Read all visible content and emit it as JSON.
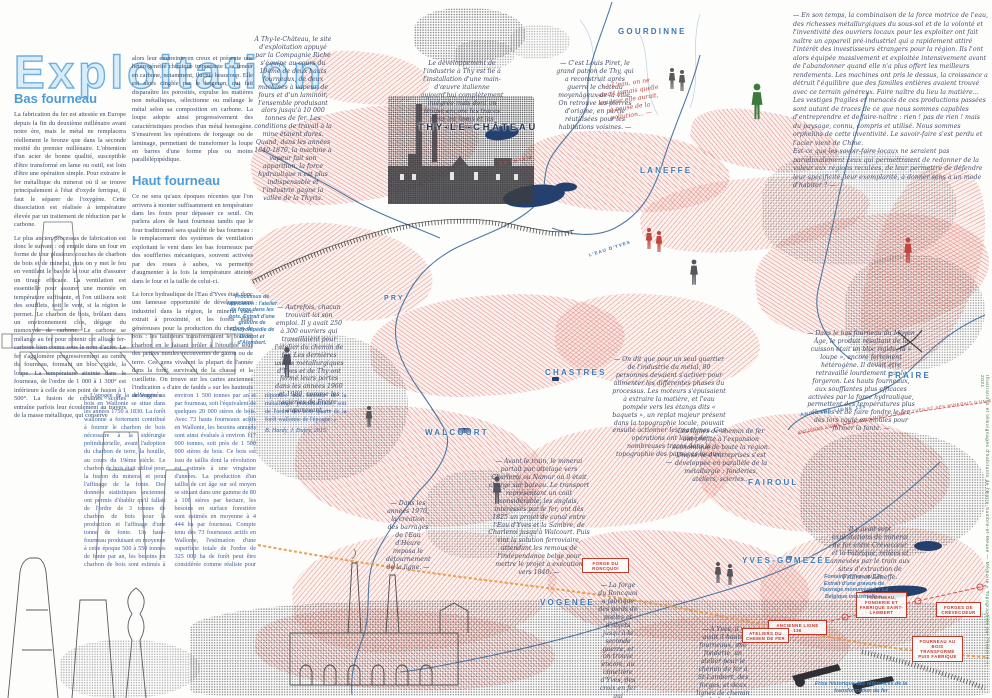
{
  "page": {
    "title": "Exploitation"
  },
  "article": {
    "bas": {
      "heading": "Bas fourneau",
      "p1": "La fabrication du fer est attestée en Europe depuis la fin du deuxième millénaire avant notre ère, mais le métal ne remplacera réellement le bronze que dans la seconde moitié du premier millénaire. L'obtention d'un acier de bonne qualité, susceptible d'être transformé en lame ou outil, est loin d'être une opération simple. Pour extraire le fer métallique du minerai où il se trouve principalement à l'état d'oxyde ferrique, il faut le séparer de l'oxygène. Cette dissociation est réalisée à température élevée par un traitement de réduction par le carbone.",
      "p2": "Le plus ancien processus de fabrication est donc le suivant : on empile dans un four en forme de tour plusieurs couches de charbon de bois et de minerai, puis on y met le feu en ventilant le bas de la tour afin d'assurer un tirage efficace. La ventilation est essentielle pour assurer une montée en température suffisante, et l'on utilisera soit des soufflets, soit le vent, si la région le permet. Le charbon de bois, brûlant dans un environnement clos, dégage du monoxyde de carbone. Le carbone se mélange au fer pour obtenir cet alliage fer-carbone bien connu sous le nom d'acier. Le fer s'agglomère progressivement au centre du fourneau, formant un bloc rigide, la loupe. La température atteinte dans le fourneau, de l'ordre de 1 000 à 1 300° est inférieure à celle de son point de fusion à 1 500°. La fusion de certaines scories entraîne parfois leur écoulement au travers de la masse métallique, qui conserve"
    },
    "cont": "alors leur empreinte en creux et présente une hétérogénéité chimique importante : sa teneur en carbone, notamment, fluctue beaucoup. Elle est alors cinglée par le forgeron, qui fait disparaître les porosités, expulse les matières non métalliques, sélectionne ou mélange le métal selon sa composition en carbone. La loupe adopte ainsi progressivement des caractéristiques proches d'un métal homogène. S'ensuivent les opérations de forgeage ou de laminage, permettant de transformer la loupe en barres d'une forme plus ou moins parallélépipédique.",
    "haut": {
      "heading": "Haut fourneau",
      "p1": "Ce ne sera qu'aux époques récentes que l'on arrivera à monter suffisamment en température dans les fours pour dépasser ce seuil. On parlera alors de haut fourneau tandis que le four traditionnel sera qualifié de bas fourneau : le remplacement des systèmes de ventilation exploitant le vent dans les bas fourneaux par des souffleries mécaniques, souvent activées par des roues à aubes, va permettre d'augmenter à la fois la température atteinte dans le four et la taille de celui-ci.",
      "p2": "La force hydraulique de l'Eau d'Yves était donc une fameuse opportunité de développement industriel dans la région, le minerai étant extrait à proximité, et les forêts étant généreuses pour la production du charbon de bois : les fauldeurs transformaient le bois en charbon en le faisant brûler à l'étouffée sous des petites meules recouvertes de gazon ou de terre. Ces gens vivaient la plupart de l'année dans la forêt, survivant de la chasse et la cueillette. On trouve sur les cartes anciennes l'indication « d'aire de faulds » sur les hauteurs de Vogenée."
    },
    "quote": {
      "text": "« L'apogée de la sidérurgie au bois en Wallonie se situe dans les années 1750 à 1830. La forêt wallonne a fortement contribué à fournir le charbon de bois nécessaire à la sidérurgie préindustrielle, avant l'adoption du charbon de terre, la houille, au cours du 19ème siècle. Le charbon de bois était utilisé pour la fusion du minerai et pour l'affinage de la fonte. Des données statistiques anciennes ont permis d'établir qu'il fallait de l'ordre de 3 tonnes de charbon de bois pour la production et l'affinage d'une tonne de fonte. Un haut-fourneau produisant en moyenne à cette époque 500 à 550 tonnes de fonte par an, les besoins en charbon de bois sont estimés à environ 1 500 tonnes par an et par fourneau, soit l'équivalent de quelques 20 000 stères de bois. Avec 73 hauts fourneaux actifs en Wallonie, les besoins annuels sont ainsi évalués à environ 117 000 tonnes, soit près de 1 500 000 stères de bois. Ce bois est issu de taillis dont la révolution est estimée à une vingtaine d'années. La production d'un taillis de cet âge sur sol moyen se situant dans une gamme de 80 à 100 stères par hectare, les besoins en surface forestière sont estimés en moyenne à 4 444 ha par fourneau. Compte tenu des 73 fourneaux actifs en Wallonie, l'estimation d'une superficie totale de l'ordre de 325 000 ha de forêt peut être considérée comme réaliste pour répondre aux besoins de la métallurgie préindustrielle, soit de l'ordre des trois quarts de la forêt wallonne de l'époque. »",
      "attribution": "B. Hardy, J. Dufey, 2015."
    }
  },
  "manifesto": {
    "text": "— En son temps, la combinaison de la force motrice de l'eau, des richesses métallurgiques du sous-sol et de la volonté et l'inventivité des ouvriers locaux pour les exploiter ont fait naître un appareil pré-industriel qui a rapidement attiré l'intérêt des investisseurs étrangers pour la région. Ils l'ont alors équipée massivement et exploitée intensivement avant de l'abandonner quand elle n'a plus offert les meilleurs rendements. Les machines ont pris le dessus, la croissance a détruit l'équilibre que des familles entières avaient trouvé avec ce terrain généreux. Faire naître du lieu la matière...\nLes vestiges fragiles et menacés de ces productions passées sont autant de traces de ce que nous sommes capables d'entreprendre et de faire-naître : rien ! pas de rien ! mais du paysage, connu, compris et utilisé. Nous sommes orphelins de cette inventivité. Le savoir-faire s'est perdu et l'acier vient de Chine.\nEst-ce que les savoir-faire locaux ne seraient pas paradoxalement ceux qui permettraient de redonner de la valeur aux régions reculées, de leur permettre de défendre leur spécificité, leur exemplarité, à donner sens à un mode d'habiter ? —"
  },
  "map": {
    "places": [
      {
        "name": "GOURDINNE"
      },
      {
        "name": "THY-LE-CHÂTEAU"
      },
      {
        "name": "LANEFFE"
      },
      {
        "name": "PRY"
      },
      {
        "name": "CHASTRES"
      },
      {
        "name": "WALCOURT"
      },
      {
        "name": "FRAIRE"
      },
      {
        "name": "FAIROUL"
      },
      {
        "name": "YVES-GOMEZÉE"
      },
      {
        "name": "VOGENÉE"
      }
    ],
    "red_labels": [
      {
        "text": "Ancienne ligne 136"
      },
      {
        "text": "Fourneau, fonderie et fabrique Saint-Lambert"
      },
      {
        "text": "Forges de Crèvecoeur"
      },
      {
        "text": "Fourneau au bois transformé puis fabrique"
      },
      {
        "text": "Forge du Roncquoi"
      },
      {
        "text": "Ateliers du chemin de fer"
      }
    ],
    "line_labels": [
      {
        "text": "ANCIENNE LIGNE 135"
      },
      {
        "text": "LA THYRIA"
      },
      {
        "text": "L'EAU D'YVES"
      }
    ],
    "rail_text": "ANCIENNE LIGNE 136 — ACHEMINER L'EAU D'YVES ET SES MINERAIS D'UN SITE À L'AUTRE — 2 KM",
    "annotations": [
      {
        "text": "À Thy-le-Château, le site d'exploitation appuyé par la Compagnie Riche s'équipe au cours du 19ème de deux hauts fourneaux, de deux machines à vapeur, de fours et d'un laminoir, l'ensemble produisant alors jusqu'à 10 000 tonnes de fer. Les conditions de travail à la mine étaient dures. Quand, dans les années 1840-1870, la machine à vapeur fait son apparition, la force hydraulique n'est plus indispensable et l'industrie gagne la vallée de la Thyria."
      },
      {
        "text": "Le développement de l'industrie à Thy est lié à l'installation d'une main-d'œuvre italienne aujourd'hui complètement intégrée mais dont on trouve encore les traces dans les noms et les prénoms..."
      },
      {
        "text": "— C'est Louis Piret, le grand patron de Thy, qui a reconstruit après guerre le château moyenâgeux de la ville. On retrouve les pierres d'origine, en partie réutilisées pour les habitations voisines. —"
      },
      {
        "text": "— L'eau, on ne savait jamais quelle couleur elle aurait, à cause de la pollution... —"
      },
      {
        "text": "— On dit que pour un seul quartier de l'industrie du métal, 80 personnes devaient s'activer pour alimenter les différentes phases du processus. Les moteurs s'épuisaient à extraire la matière, et l'eau pompée vers les étangs dits « baquets », un replat majeur présent dans la topographie locale, pouvait ensuite actionner les machines. Ces opérations ont laissé de nombreuses traces dans la topographie des paysages locaux. —"
      },
      {
        "text": "Les lignes de chemin de fer ont profité à l'expansion économique de toute la région. Une série d'entreprises s'est développée en parallèle de la métallurgie : fonderies, ateliers, scieries..."
      },
      {
        "text": "— Avant le train, le minerai partait par attelage vers Charleroi ou Namur où il était chargé sur bateau. Le transport représentant un coût considérable, les anglais, intéressés par le fer, ont dès 1825 un projet de canal entre l'Eau d'Yves et la Sambre, de Charleroi jusqu'à Walcourt. Puis vint la solution ferroviaire, attendant les remous de l'indépendance belge pour mettre le projet à exécution vers 1840. —"
      },
      {
        "text": "— Dans le bas fourneau du Moyen Âge, le produit résultant de la cuisson était un bloc rigide, la « loupe », encore fortement hétérogène. Il devait être retravaillé lourdement par le forgeron. Les hauts fourneaux, aux soufflantes plus efficaces activées par la force hydraulique, permettent des températures plus élevées et de faire fondre le fer, dès lors coulé en moules pour former la fonte. —"
      },
      {
        "text": "— À Yves, il y avait 3 hauts fourneaux, une fonderie, un atelier pour le chemin de fer à St-Lambert, des forges, et deux lignes de chemin de fer ! —"
      },
      {
        "text": "— La forge du Roncquoi a fabriqué des pieds de poêles et d'objets jusqu'à la seconde guerre, et on trouve encore, au cimetière d'Yves, des croix en fer qui proviennent aussi de là. —"
      },
      {
        "text": "— Autrefois, chacun trouvait ici son emploi. Il y avait 250 à 300 ouvriers qui travaillaient pour l'atelier du chemin de fer. Les dernières usines métallurgiques d'Yves et de Thy ont fermé leurs portes dans les années 1960 et 1980, comme les aciéries de Fraire auparavant. —"
      },
      {
        "text": "Il y avait sept exploitations de minerai de fer entre Crèvecœur et la Fabrique, reliées et annexées par le train aux sites d'extraction de Fraire et Laneffe."
      },
      {
        "text": "— Dans les années 1970, la création des barrages de l'Eau d'Heure imposa le détournement de la ligne. —"
      }
    ],
    "captions": {
      "c1": "Processus de fabrication : l'atelier de forge dans les bois. Extrait d'une gravure de l'Encyclopédie de Diderot et d'Alembert.",
      "c2": "Fontaine d'Yves au 17e. Extrait d'une gravure de l'ouvrage monumental « La Belgique industrielle ».",
      "c3": "Frise historique des références de la transformation du fer"
    }
  },
  "credit": "Illustrations et témoignages d'habitants de l'Entre-Sambre-et-Meuse — Mémoire « Topographies par l'histoire », 2021",
  "colors": {
    "accent_blue": "#4d9bd4",
    "label_blue": "#3c78b4",
    "quote_blue": "#3b5fa0",
    "terrain_pink": "#de7a6e",
    "river_blue": "#46719f",
    "pond_navy": "#24406e",
    "rail_orange": "#e8973f",
    "red": "#c0463f",
    "green": "#3d7a3d"
  }
}
